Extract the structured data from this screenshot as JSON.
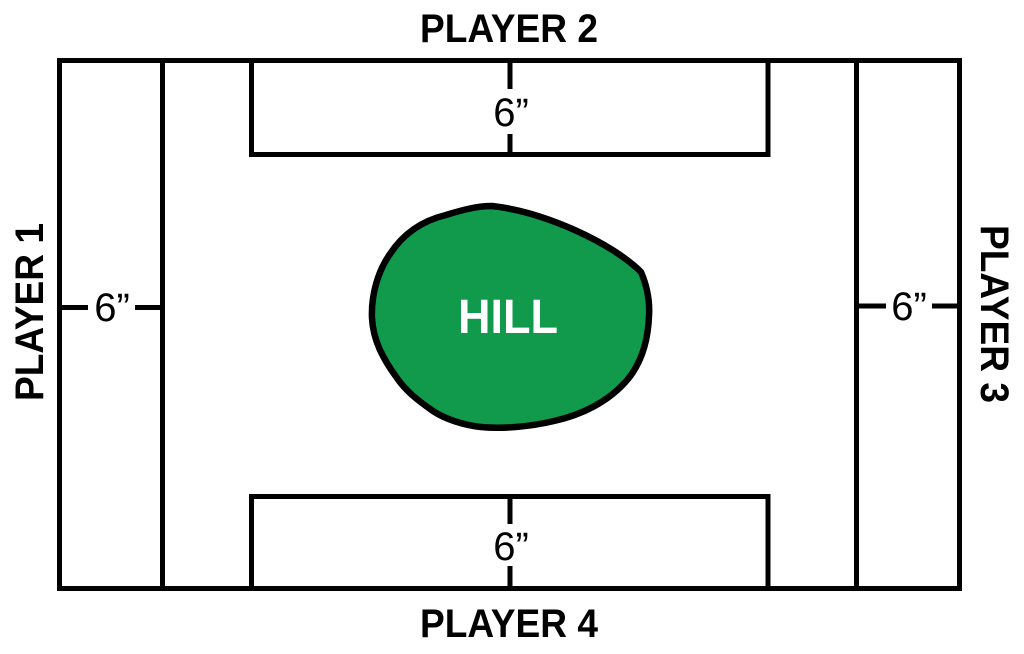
{
  "board": {
    "background_color": "#ffffff",
    "line_color": "#000000",
    "players": {
      "left": "PLAYER 1",
      "top": "PLAYER 2",
      "right": "PLAYER 3",
      "bottom": "PLAYER 4"
    },
    "deployment_measurements": {
      "left": "6”",
      "top": "6”",
      "right": "6”",
      "bottom": "6”"
    },
    "hill": {
      "label": "HILL",
      "fill_color": "#119a4c",
      "outline_color": "#000000",
      "text_color": "#ffffff"
    }
  }
}
